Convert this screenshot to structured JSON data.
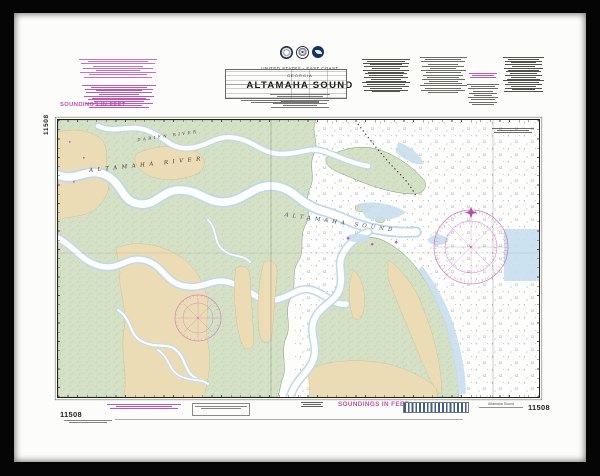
{
  "header": {
    "nation": "UNITED STATES - EAST COAST",
    "region": "GEORGIA",
    "title": "ALTAMAHA SOUND"
  },
  "margins": {
    "soundings_top": "SOUNDINGS IN FEET",
    "soundings_bottom": "SOUNDINGS IN FEET",
    "chart_number": "11508",
    "imprint": "Altamaha Sound"
  },
  "map_labels": {
    "altamaha_river": "ALTAMAHA RIVER",
    "darien_river": "DARIEN RIVER",
    "altamaha_sound": "ALTAMAHA SOUND"
  },
  "icons": {
    "seals": [
      "commerce-seal-icon",
      "coast-survey-seal-icon",
      "noaa-seal-icon"
    ],
    "compass_roses": [
      "land-compass-rose-icon",
      "ocean-compass-rose-icon"
    ],
    "north_star": "north-star-icon"
  },
  "colors": {
    "frame_black": "#050505",
    "mat_white": "#fcfcfa",
    "marsh_green": "#d5e1c6",
    "land_tan": "#ecdcb6",
    "shallow_blue": "#c8dfee",
    "note_magenta": "#bb4fae",
    "ink": "#20201c"
  }
}
